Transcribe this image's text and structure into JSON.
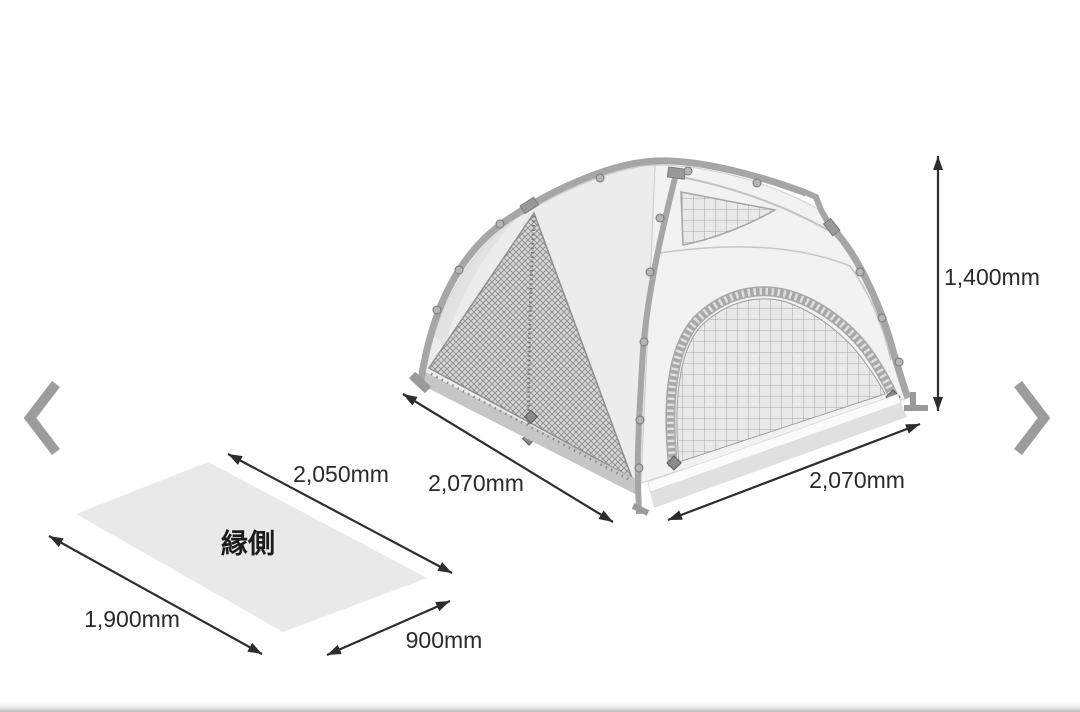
{
  "carousel": {
    "prev_icon": "chevron-left-icon",
    "next_icon": "chevron-right-icon"
  },
  "diagram": {
    "tent": {
      "height": "1,400mm",
      "width_left": "2,070mm",
      "width_right": "2,070mm"
    },
    "sheet": {
      "label": "縁側",
      "edge_top": "2,050mm",
      "edge_left": "1,900mm",
      "edge_right": "900mm"
    },
    "colors": {
      "dimension": "#2d2d2d",
      "pole": "#a6a6a6",
      "fabric_left": "#ececec",
      "fabric_right": "#f2f2f2",
      "mesh_dark": "#d5d5d5",
      "mesh_light": "#e9e9e9",
      "skirt": "#c6c6c6",
      "sheet_fill": "#e9e9e9",
      "chevron": "#9c9c9c"
    }
  }
}
